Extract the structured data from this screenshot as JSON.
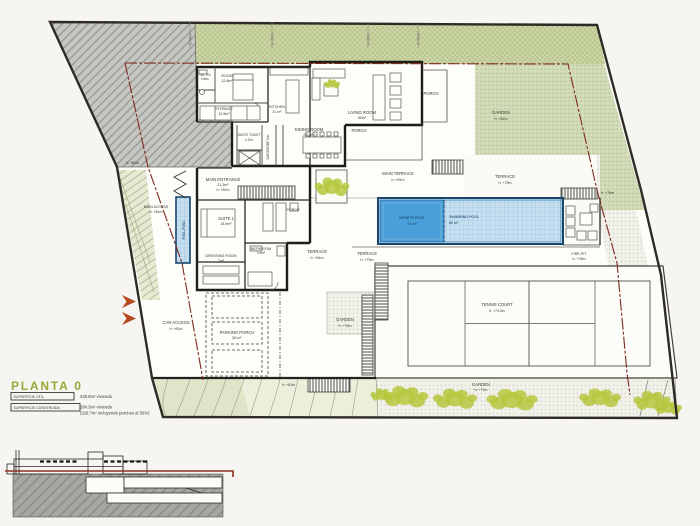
{
  "plan": {
    "title": "PLANTA 0",
    "legend": {
      "useful_label": "SUPERFICIE ÚTIL.",
      "useful_value": "228.8m² vivienda",
      "built_label": "SUPERFICIE CONSTRUIDA",
      "built_value": "284.3m² vivienda",
      "built_note": "(329.7m² incluyendo porches al 50%)"
    }
  },
  "rooms": {
    "gu_toilet": {
      "label": "GU.TOI",
      "area": "4.8m²"
    },
    "room": {
      "label": "ROOM",
      "area": "12.8m²"
    },
    "storage": {
      "label": "STORAGE",
      "area": "12.5m²"
    },
    "kitchen": {
      "label": "KITCHEN",
      "area": "21 m²"
    },
    "dining": {
      "label": "DINING ROOM",
      "area": "29.2m²"
    },
    "living": {
      "label": "LIVING ROOM",
      "area": "50m²"
    },
    "guest_toilet": {
      "label": "GUEST TOILET",
      "area": "4.7m²"
    },
    "wardrobe": {
      "label": "WARDROBE 5m²"
    },
    "main_entrance": {
      "label": "MAIN ENTRANCE",
      "area": "21.3m²",
      "level": "h: +81m"
    },
    "suite": {
      "label": "SUITE 1",
      "area": "18.9m²"
    },
    "dressing": {
      "label": "DRESSING ROOM",
      "area": "7m²"
    },
    "bathroom": {
      "label": "BATHROOM",
      "area": "14m²"
    },
    "porch": "PORCH",
    "parking": {
      "label": "PARKING PORCH",
      "area": "50 m²"
    }
  },
  "outdoor": {
    "main_terrace": {
      "label": "MAIN TERRACE",
      "level": "h: +81m"
    },
    "terrace_79": {
      "label": "TERRACE",
      "level": "h: +79m"
    },
    "terrace_81": {
      "label": "TERRACE",
      "level": "h: +81m"
    },
    "garden_top": {
      "label": "GARDEN",
      "level": "h: +81m"
    },
    "garden_mid": {
      "label": "GARDEN",
      "level": "h: +76m"
    },
    "garden_bottom": {
      "label": "GARDEN",
      "level": "h: +73m"
    },
    "tennis": {
      "label": "TENNIS COURT",
      "level": "h: +74.0m"
    },
    "fire_pit": {
      "label": "FIRE-PIT",
      "level": "h: +78m"
    },
    "main_access": {
      "label": "MAIN ACCESS",
      "level": "h: +81m"
    },
    "car_access": {
      "label": "CAR ACCESS",
      "level": "h: +81m"
    },
    "pool_pond": "POOL-POND"
  },
  "pool": {
    "infinite": {
      "label": "INFINITE POOL",
      "area": "21 m²"
    },
    "swimming": {
      "label": "SWIMMING POOL",
      "area": "80 m²"
    }
  },
  "marks": {
    "level_81": "h: +81m",
    "level_79": "h: +79m"
  },
  "colors": {
    "accent_title": "#99a73b",
    "pool_blue": "#4a9fd8",
    "pool_light": "#c6dff0",
    "setback_red": "#7e2920",
    "garden_green": "#d3dcb8",
    "bush_green": "#b5c83e"
  }
}
